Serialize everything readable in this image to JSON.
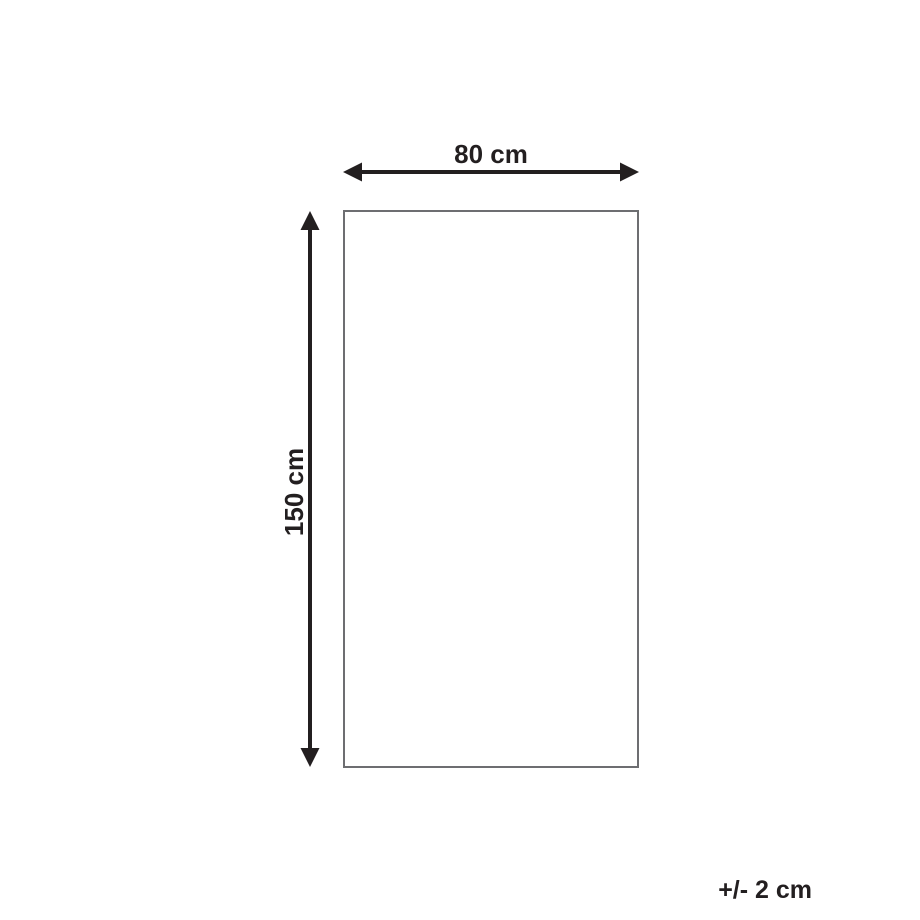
{
  "diagram": {
    "width_label": "80 cm",
    "height_label": "150 cm",
    "tolerance_label": "+/- 2 cm"
  },
  "colors": {
    "arrow": "#231f20",
    "outline": "#6d6e71",
    "background": "#ffffff"
  }
}
